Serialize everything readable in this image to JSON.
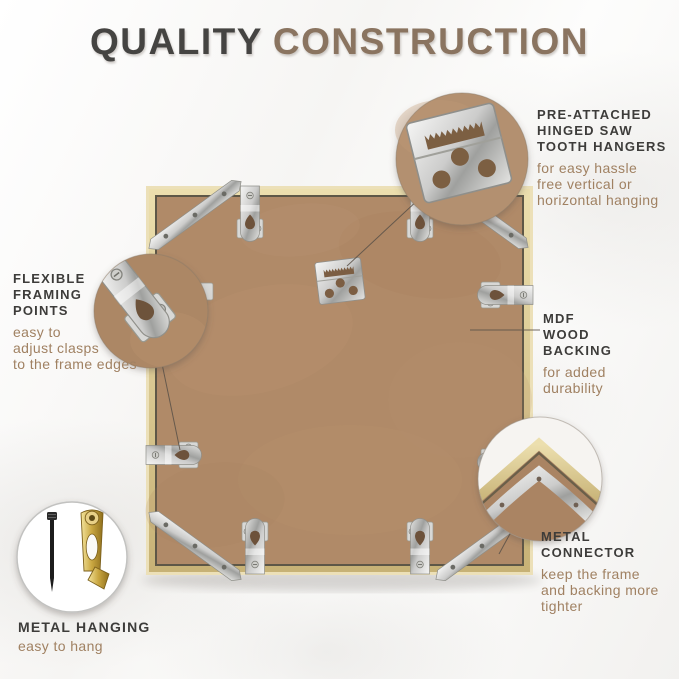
{
  "title": {
    "word1": "QUALITY",
    "word2": "CONSTRUCTION"
  },
  "annotations": {
    "hangers": {
      "heading": [
        "PRE-ATTACHED",
        "HINGED SAW",
        "TOOTH HANGERS"
      ],
      "body": [
        "for easy hassle",
        "free vertical or",
        "horizontal hanging"
      ]
    },
    "framing_points": {
      "heading": [
        "FLEXIBLE",
        "FRAMING",
        "POINTS"
      ],
      "body": [
        "easy to",
        "adjust clasps",
        "to the frame edges"
      ]
    },
    "mdf_backing": {
      "heading": [
        "MDF",
        "WOOD",
        "BACKING"
      ],
      "body": [
        "for added",
        "durability"
      ]
    },
    "metal_connector": {
      "heading": [
        "METAL",
        "CONNECTOR"
      ],
      "body": [
        "keep the frame",
        "and backing  more",
        "tighter"
      ]
    },
    "metal_hanging": {
      "heading": [
        "METAL HANGING"
      ],
      "body": [
        "easy to hang"
      ]
    }
  },
  "icons": {
    "sawtooth_hanger_closeup": "sawtooth-hanger-icon",
    "framing_point_closeup": "framing-point-clip-icon",
    "corner_connector_closeup": "metal-corner-connector-icon",
    "nail_and_hook": "nail-and-brass-hook-icon"
  },
  "colors": {
    "title_dark": "#454442",
    "title_brown": "#8a7460",
    "heading_text": "#3d3c3a",
    "body_text": "#a08162",
    "frame_gold": "#d3be87",
    "mdf_brown": "#b08a68",
    "metal_silver": "#c9c9c7",
    "brass": "#c9a640",
    "background": "#f7f6f4"
  }
}
